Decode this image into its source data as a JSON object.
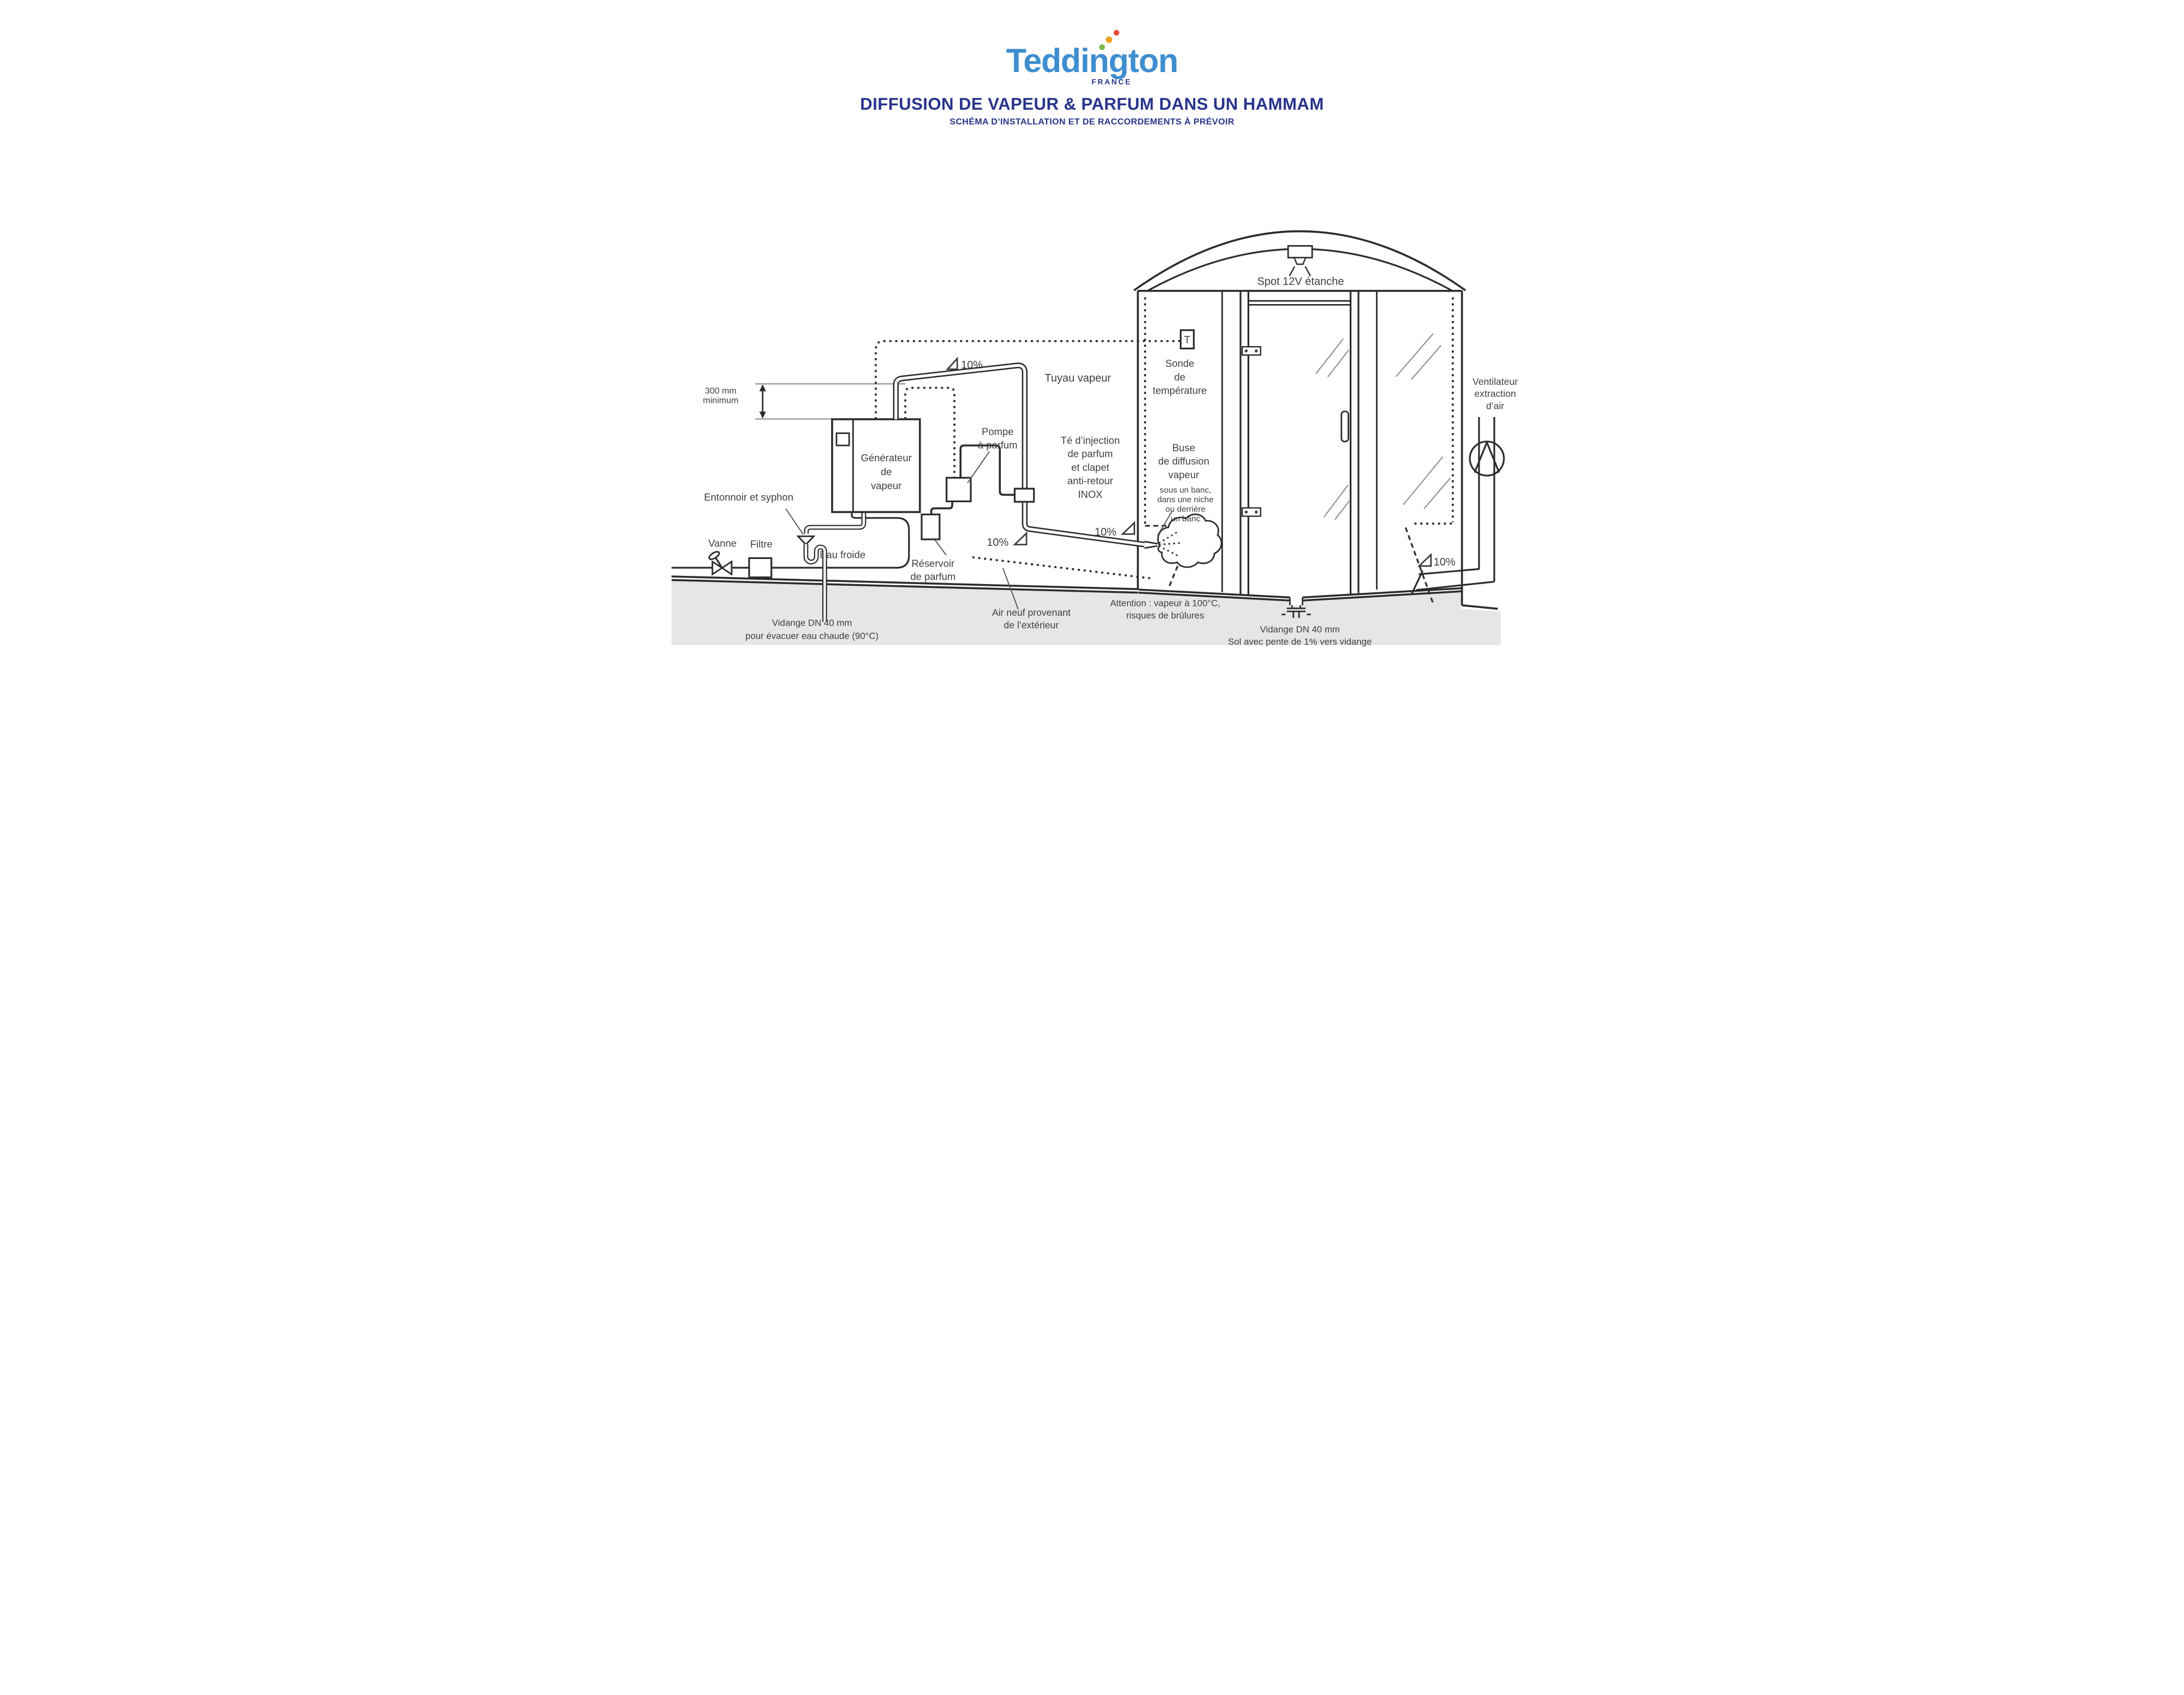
{
  "header": {
    "logo_text": "Teddington",
    "logo_country": "FRANCE",
    "title": "DIFFUSION DE VAPEUR & PARFUM DANS UN HAMMAM",
    "subtitle": "SCHÉMA D’INSTALLATION ET DE RACCORDEMENTS À PRÉVOIR"
  },
  "colors": {
    "logo_blue": "#3e8ed0",
    "title_blue": "#27348b",
    "line_dark": "#2e2b2c",
    "label_gray": "#3f3f3f",
    "ground_gray": "#e7e6e6",
    "dot_green": "#7ab648",
    "dot_orange": "#f5a11c",
    "dot_red": "#e94f35"
  },
  "labels": {
    "dim_300mm": [
      "300 mm",
      "minimum"
    ],
    "generator": [
      "Générateur",
      "de",
      "vapeur"
    ],
    "entonnoir": "Entonnoir et syphon",
    "vanne": "Vanne",
    "filtre": "Filtre",
    "eau_froide": "Eau froide",
    "pompe": [
      "Pompe",
      "à parfum"
    ],
    "reservoir": [
      "Réservoir",
      "de parfum"
    ],
    "tuyau_vapeur": "Tuyau vapeur",
    "te_injection": [
      "Té d’injection",
      "de parfum",
      "et clapet",
      "anti-retour",
      "INOX"
    ],
    "slope": "10%",
    "sonde": [
      "Sonde",
      "de",
      "température"
    ],
    "sensor_t": "T",
    "buse": [
      "Buse",
      "de diffusion",
      "vapeur"
    ],
    "buse_sub": [
      "sous un banc,",
      "dans une niche",
      "ou derrière",
      "un banc"
    ],
    "spot": "Spot 12V étanche",
    "ventilateur": [
      "Ventilateur",
      "extraction",
      "d’air"
    ],
    "air_neuf": [
      "Air neuf provenant",
      "de l’extérieur"
    ],
    "attention": [
      "Attention : vapeur à 100°C,",
      "risques de brûlures"
    ],
    "vidange_gauche": [
      "Vidange DN 40 mm",
      "pour évacuer eau chaude (90°C)"
    ],
    "vidange_droite": [
      "Vidange DN 40 mm",
      "Sol avec pente de 1% vers vidange"
    ]
  }
}
